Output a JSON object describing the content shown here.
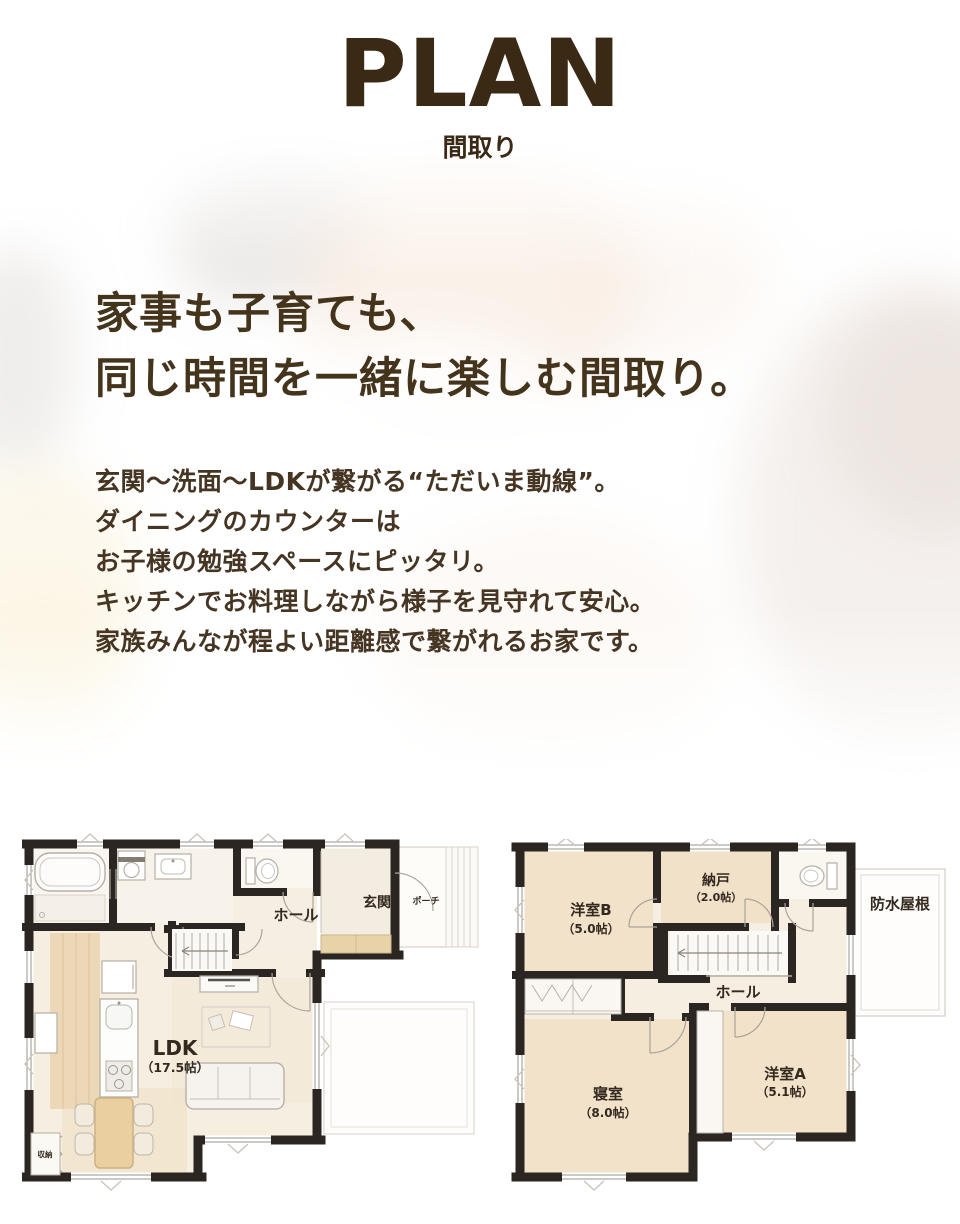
{
  "header": {
    "title": "PLAN",
    "subtitle": "間取り"
  },
  "intro": {
    "heading_lines": [
      "家事も子育ても、",
      "同じ時間を一緒に楽しむ間取り。"
    ],
    "body_lines": [
      "玄関〜洗面〜LDKが繋がる“ただいま動線”。",
      "ダイニングのカウンターは",
      "お子様の勉強スペースにピッタリ。",
      "キッチンでお料理しながら様子を見守れて安心。",
      "家族みんなが程よい距離感で繋がれるお家です。"
    ]
  },
  "colors": {
    "text_brown": "#45341c",
    "wall": "#2b2622",
    "floor_cream": "#f6eee1",
    "floor_tan": "#f1e2c9",
    "cabinet_tan": "#e8d3a9"
  },
  "floorplan_1f": {
    "hall": "ホール",
    "entrance": "玄関",
    "porch": "ポーチ",
    "ldk": "LDK",
    "ldk_size": "（17.5帖）",
    "storage": "収納"
  },
  "floorplan_2f": {
    "room_b": "洋室B",
    "room_b_size": "（5.0帖）",
    "storeroom": "納戸",
    "storeroom_size": "（2.0帖）",
    "roof": "防水屋根",
    "hall": "ホール",
    "bedroom": "寝室",
    "bedroom_size": "（8.0帖）",
    "room_a": "洋室A",
    "room_a_size": "（5.1帖）"
  }
}
